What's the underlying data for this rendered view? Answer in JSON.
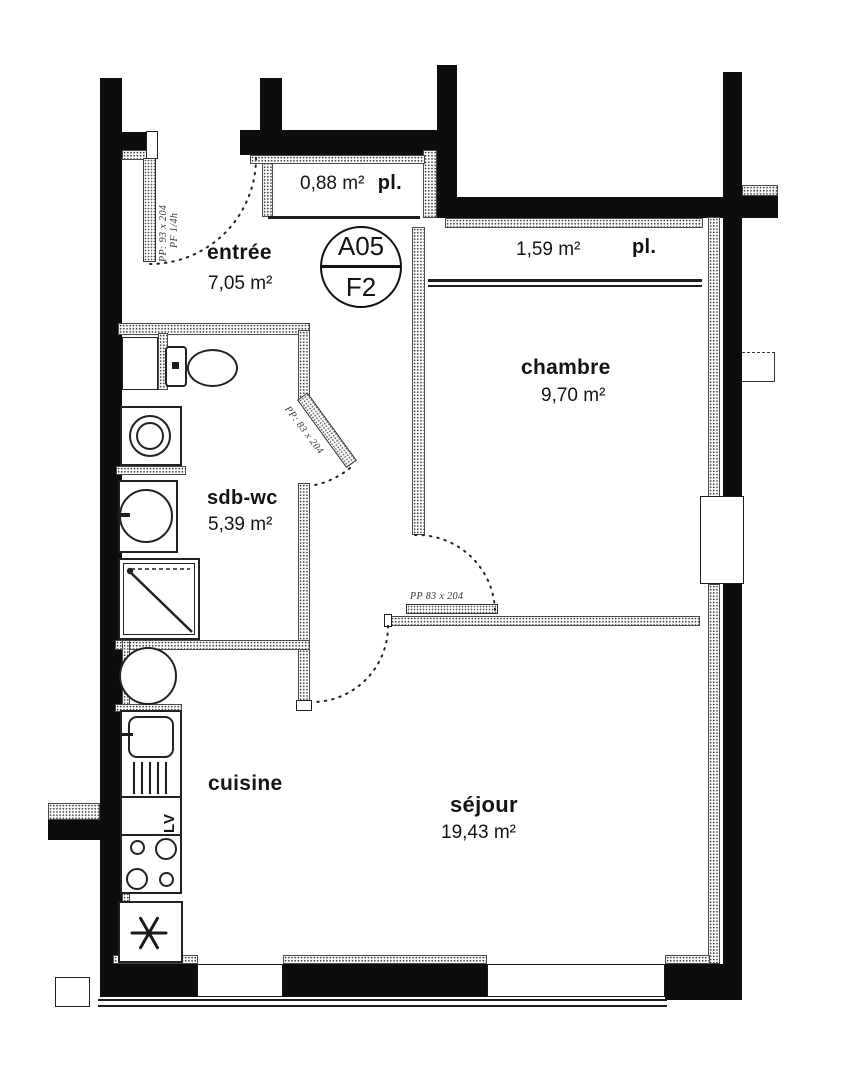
{
  "unit": {
    "code": "A05",
    "type": "F2"
  },
  "rooms": {
    "entree": {
      "name": "entrée",
      "area": "7,05 m²"
    },
    "closet_entree": {
      "label": "pl.",
      "area": "0,88 m²"
    },
    "closet_chambre": {
      "label": "pl.",
      "area": "1,59 m²"
    },
    "chambre": {
      "name": "chambre",
      "area": "9,70 m²"
    },
    "sdb": {
      "name": "sdb-wc",
      "area": "5,39 m²"
    },
    "cuisine": {
      "name": "cuisine"
    },
    "sejour": {
      "name": "séjour",
      "area": "19,43 m²"
    }
  },
  "doors": {
    "entrance": {
      "label": "PP: 93 x 204",
      "sublabel": "PF 1/4h"
    },
    "sdb": {
      "label": "PP: 83 x 204"
    },
    "sejour": {
      "label": "PP 83 x 204"
    }
  },
  "appliances": {
    "dishwasher": "LV"
  },
  "colors": {
    "wall": "#0d0d0d",
    "paper": "#ffffff",
    "ink": "#141414"
  }
}
